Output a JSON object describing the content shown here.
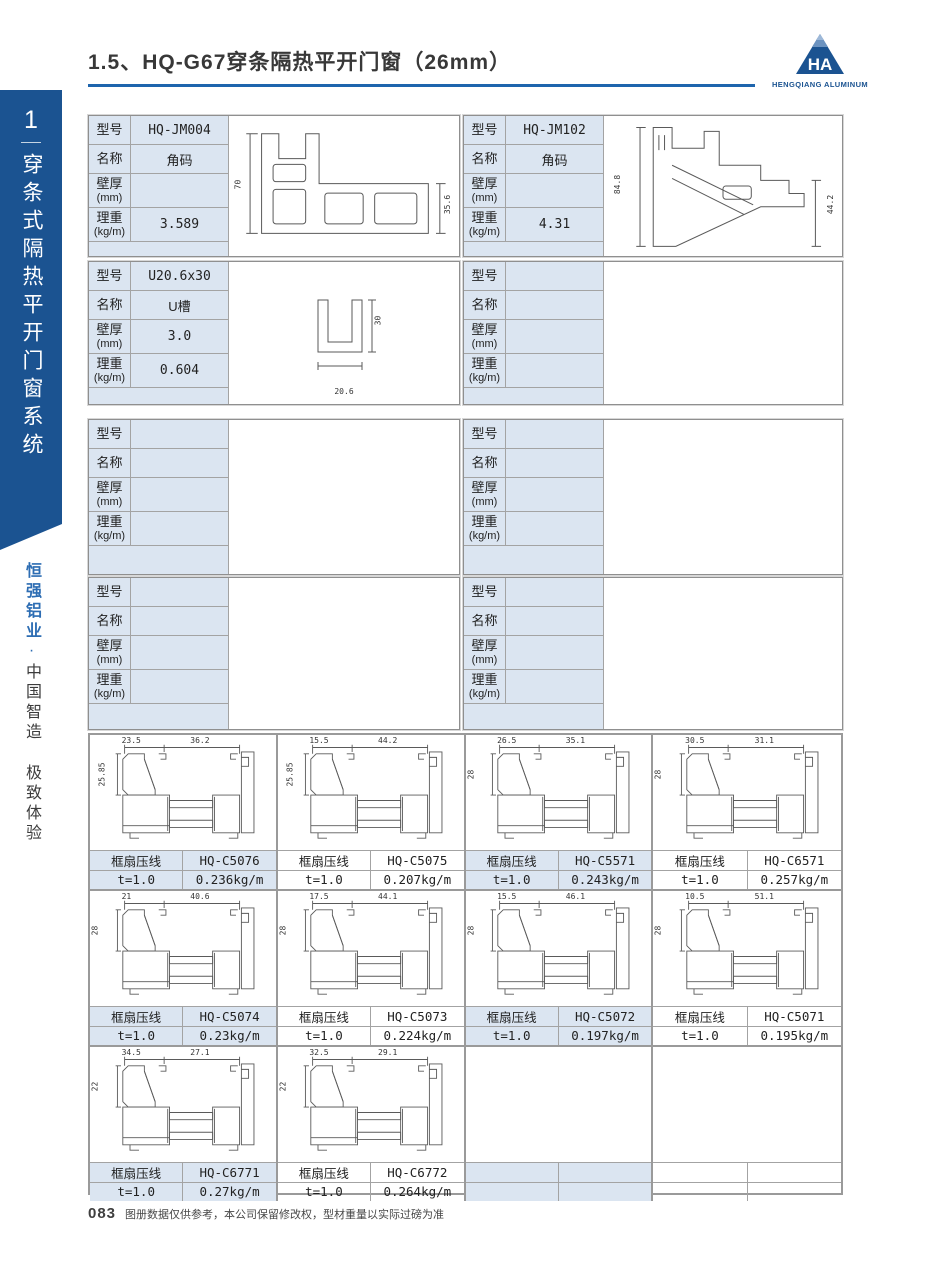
{
  "colors": {
    "brand_blue": "#1b5391",
    "cell_blue": "#dbe5f1",
    "underline_blue": "#1e65ad"
  },
  "header": {
    "title": "1.5、HQ-G67穿条隔热平开门窗（26mm）"
  },
  "logo": {
    "monogram": "HA",
    "caption": "HENGQIANG ALUMINUM"
  },
  "sidebar": {
    "chapter_number": "1",
    "chapter_title": "穿条式隔热平开门窗系统",
    "slogan_brand": "恒强铝业",
    "slogan_dot": "·",
    "slogan_rest": "中国智造 极致体验"
  },
  "labels": {
    "model": "型号",
    "name": "名称",
    "thickness_line1": "壁厚",
    "thickness_line2": "(mm)",
    "weight_line1": "理重",
    "weight_line2": "(kg/m)"
  },
  "spec_tables": [
    {
      "model": "HQ-JM004",
      "name": "角码",
      "thickness": "",
      "weight": "3.589",
      "dims": {
        "left": "70",
        "right": "35.6"
      }
    },
    {
      "model": "HQ-JM102",
      "name": "角码",
      "thickness": "",
      "weight": "4.31",
      "dims": {
        "left": "84.8",
        "right": "44.2"
      }
    },
    {
      "model": "U20.6x30",
      "name": "U槽",
      "thickness": "3.0",
      "weight": "0.604",
      "dims": {
        "right": "30",
        "bottom": "20.6"
      }
    },
    {
      "model": "",
      "name": "",
      "thickness": "",
      "weight": ""
    },
    {
      "model": "",
      "name": "",
      "thickness": "",
      "weight": ""
    },
    {
      "model": "",
      "name": "",
      "thickness": "",
      "weight": ""
    },
    {
      "model": "",
      "name": "",
      "thickness": "",
      "weight": ""
    },
    {
      "model": "",
      "name": "",
      "thickness": "",
      "weight": ""
    }
  ],
  "bead_profiles": [
    {
      "label": "框扇压线",
      "model": "HQ-C5076",
      "t": "t=1.0",
      "weight": "0.236kg/m",
      "dims": {
        "h": "25.85",
        "top1": "23.5",
        "top2": "36.2"
      }
    },
    {
      "label": "框扇压线",
      "model": "HQ-C5075",
      "t": "t=1.0",
      "weight": "0.207kg/m",
      "dims": {
        "h": "25.85",
        "top1": "15.5",
        "top2": "44.2"
      }
    },
    {
      "label": "框扇压线",
      "model": "HQ-C5571",
      "t": "t=1.0",
      "weight": "0.243kg/m",
      "dims": {
        "h": "28",
        "top1": "26.5",
        "top2": "35.1"
      }
    },
    {
      "label": "框扇压线",
      "model": "HQ-C6571",
      "t": "t=1.0",
      "weight": "0.257kg/m",
      "dims": {
        "h": "28",
        "top1": "30.5",
        "top2": "31.1"
      }
    },
    {
      "label": "框扇压线",
      "model": "HQ-C5074",
      "t": "t=1.0",
      "weight": "0.23kg/m",
      "dims": {
        "h": "28",
        "top1": "21",
        "top2": "40.6"
      }
    },
    {
      "label": "框扇压线",
      "model": "HQ-C5073",
      "t": "t=1.0",
      "weight": "0.224kg/m",
      "dims": {
        "h": "28",
        "top1": "17.5",
        "top2": "44.1"
      }
    },
    {
      "label": "框扇压线",
      "model": "HQ-C5072",
      "t": "t=1.0",
      "weight": "0.197kg/m",
      "dims": {
        "h": "28",
        "top1": "15.5",
        "top2": "46.1"
      }
    },
    {
      "label": "框扇压线",
      "model": "HQ-C5071",
      "t": "t=1.0",
      "weight": "0.195kg/m",
      "dims": {
        "h": "28",
        "top1": "10.5",
        "top2": "51.1"
      }
    },
    {
      "label": "框扇压线",
      "model": "HQ-C6771",
      "t": "t=1.0",
      "weight": "0.27kg/m",
      "dims": {
        "h": "22",
        "top1": "34.5",
        "top2": "27.1"
      }
    },
    {
      "label": "框扇压线",
      "model": "HQ-C6772",
      "t": "t=1.0",
      "weight": "0.264kg/m",
      "dims": {
        "h": "22",
        "top1": "32.5",
        "top2": "29.1"
      }
    },
    {
      "label": "",
      "model": "",
      "t": "",
      "weight": ""
    },
    {
      "label": "",
      "model": "",
      "t": "",
      "weight": ""
    }
  ],
  "footer": {
    "page_number": "083",
    "note": "图册数据仅供参考，本公司保留修改权，型材重量以实际过磅为准"
  }
}
